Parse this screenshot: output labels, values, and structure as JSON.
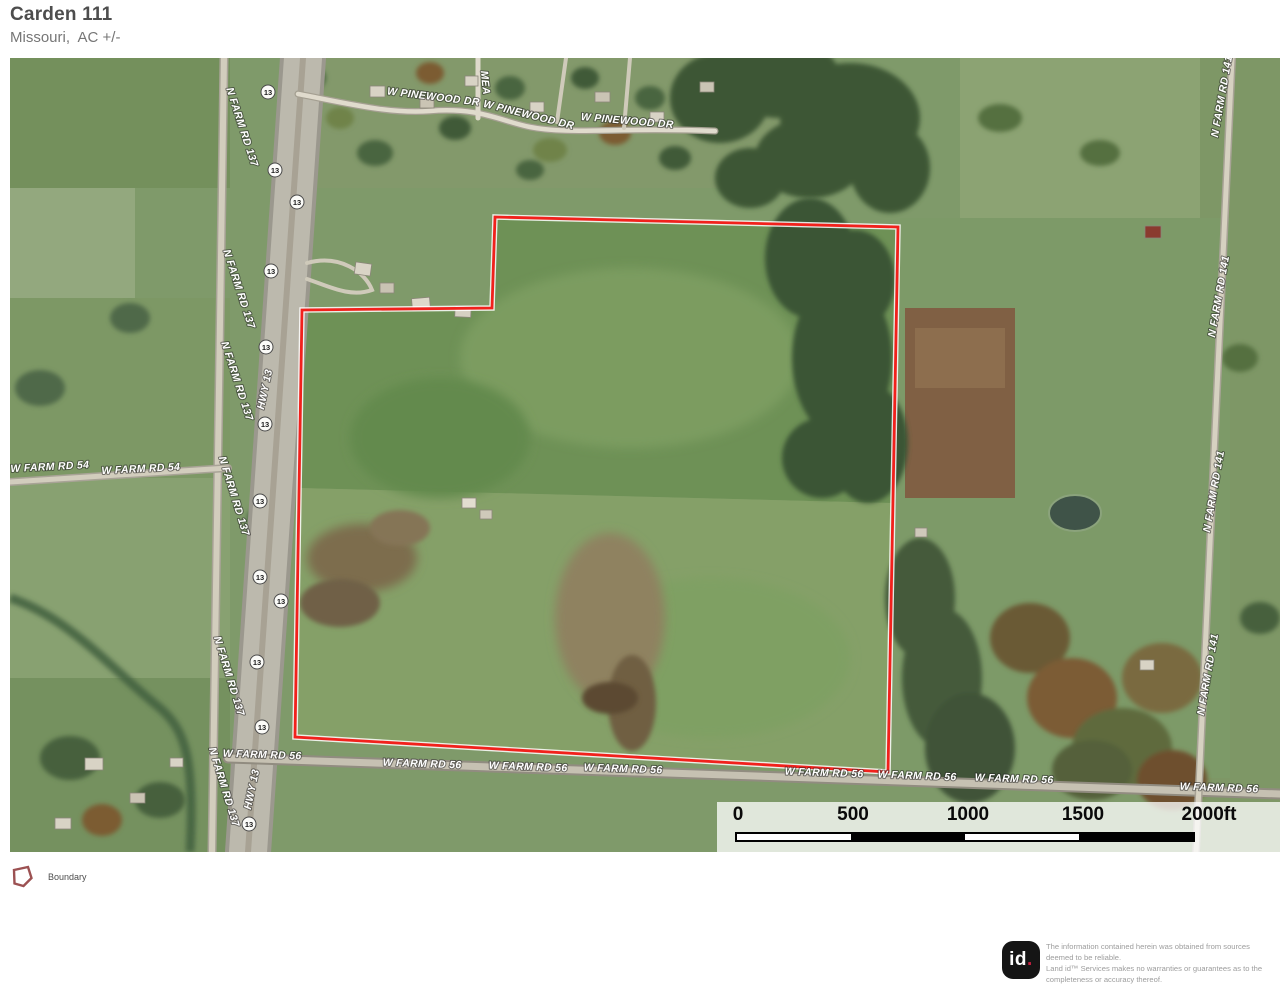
{
  "header": {
    "title": "Carden 111",
    "subtitle": "Missouri,  AC +/-"
  },
  "map": {
    "labels": {
      "pinewood": "W PINEWOOD DR",
      "mea": "MEA",
      "farm137": "N FARM RD 137",
      "hwy13": "HWY 13",
      "farm54": "W FARM RD 54",
      "farm56": "W FARM RD 56",
      "farm141": "N FARM RD 141",
      "shield": "13"
    },
    "boundary_color": "#f1211c"
  },
  "scalebar": {
    "t0": "0",
    "t1": "500",
    "t2": "1000",
    "t3": "1500",
    "t4": "2000ft"
  },
  "legend": {
    "boundary_label": "Boundary",
    "icon_color": "#9c5152"
  },
  "footer": {
    "logo_text": "id",
    "logo_dot": ".",
    "disclaimer": [
      "The information contained herein was obtained from sources",
      "deemed to be reliable.",
      "Land id™ Services makes no warranties or guarantees as to the",
      "completeness or accuracy thereof."
    ]
  }
}
